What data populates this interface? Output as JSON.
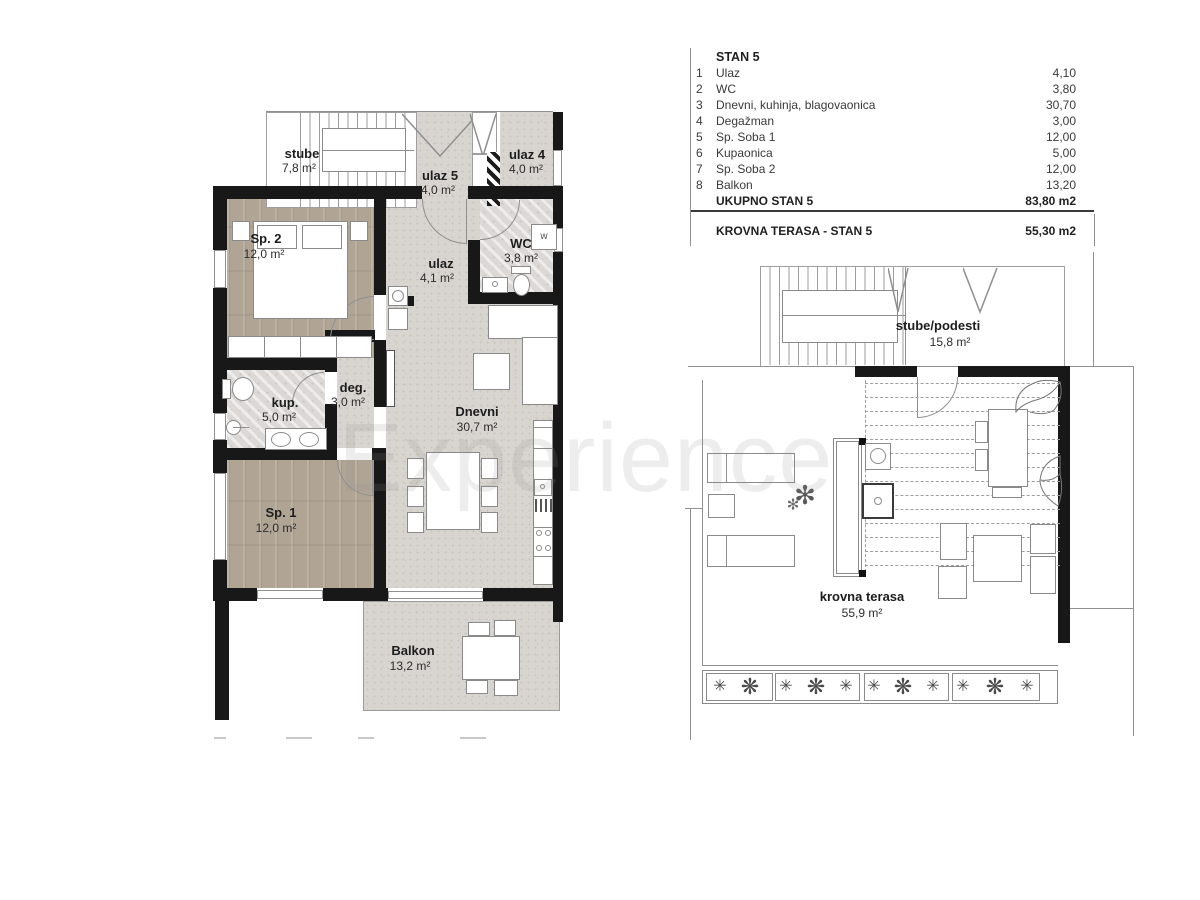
{
  "watermark": {
    "text": "Experience"
  },
  "table": {
    "title": "STAN 5",
    "rows": [
      {
        "num": "1",
        "name": "Ulaz",
        "value": "4,10"
      },
      {
        "num": "2",
        "name": "WC",
        "value": "3,80"
      },
      {
        "num": "3",
        "name": "Dnevni, kuhinja, blagovaonica",
        "value": "30,70"
      },
      {
        "num": "4",
        "name": "Degažman",
        "value": "3,00"
      },
      {
        "num": "5",
        "name": "Sp. Soba 1",
        "value": "12,00"
      },
      {
        "num": "6",
        "name": "Kupaonica",
        "value": "5,00"
      },
      {
        "num": "7",
        "name": "Sp. Soba 2",
        "value": "12,00"
      },
      {
        "num": "8",
        "name": "Balkon",
        "value": "13,20"
      }
    ],
    "total": {
      "name": "UKUPNO STAN 5",
      "value": "83,80 m2"
    },
    "terrace": {
      "name": "KROVNA TERASA - STAN 5",
      "value": "55,30 m2"
    }
  },
  "plan_left": {
    "rooms": [
      {
        "id": "stube",
        "label": "stube",
        "area": "7,8 m²"
      },
      {
        "id": "ulaz5",
        "label": "ulaz 5",
        "area": "4,0 m²"
      },
      {
        "id": "ulaz4",
        "label": "ulaz 4",
        "area": "4,0 m²"
      },
      {
        "id": "sp2",
        "label": "Sp. 2",
        "area": "12,0 m²"
      },
      {
        "id": "ulaz",
        "label": "ulaz",
        "area": "4,1 m²"
      },
      {
        "id": "wc",
        "label": "WC",
        "area": "3,8 m²"
      },
      {
        "id": "kup",
        "label": "kup.",
        "area": "5,0 m²"
      },
      {
        "id": "deg",
        "label": "deg.",
        "area": "3,0 m²"
      },
      {
        "id": "sp1",
        "label": "Sp. 1",
        "area": "12,0 m²"
      },
      {
        "id": "dnevni",
        "label": "Dnevni",
        "area": "30,7 m²"
      },
      {
        "id": "balkon",
        "label": "Balkon",
        "area": "13,2 m²"
      }
    ],
    "wc_washer": "w"
  },
  "plan_right": {
    "rooms": [
      {
        "id": "stube_podesti",
        "label": "stube/podesti",
        "area": "15,8 m²"
      },
      {
        "id": "krovna_terasa",
        "label": "krovna terasa",
        "area": "55,9 m²"
      }
    ],
    "planter_star": "✳",
    "planter_tree": "❋",
    "plant_glyph": "✻"
  }
}
